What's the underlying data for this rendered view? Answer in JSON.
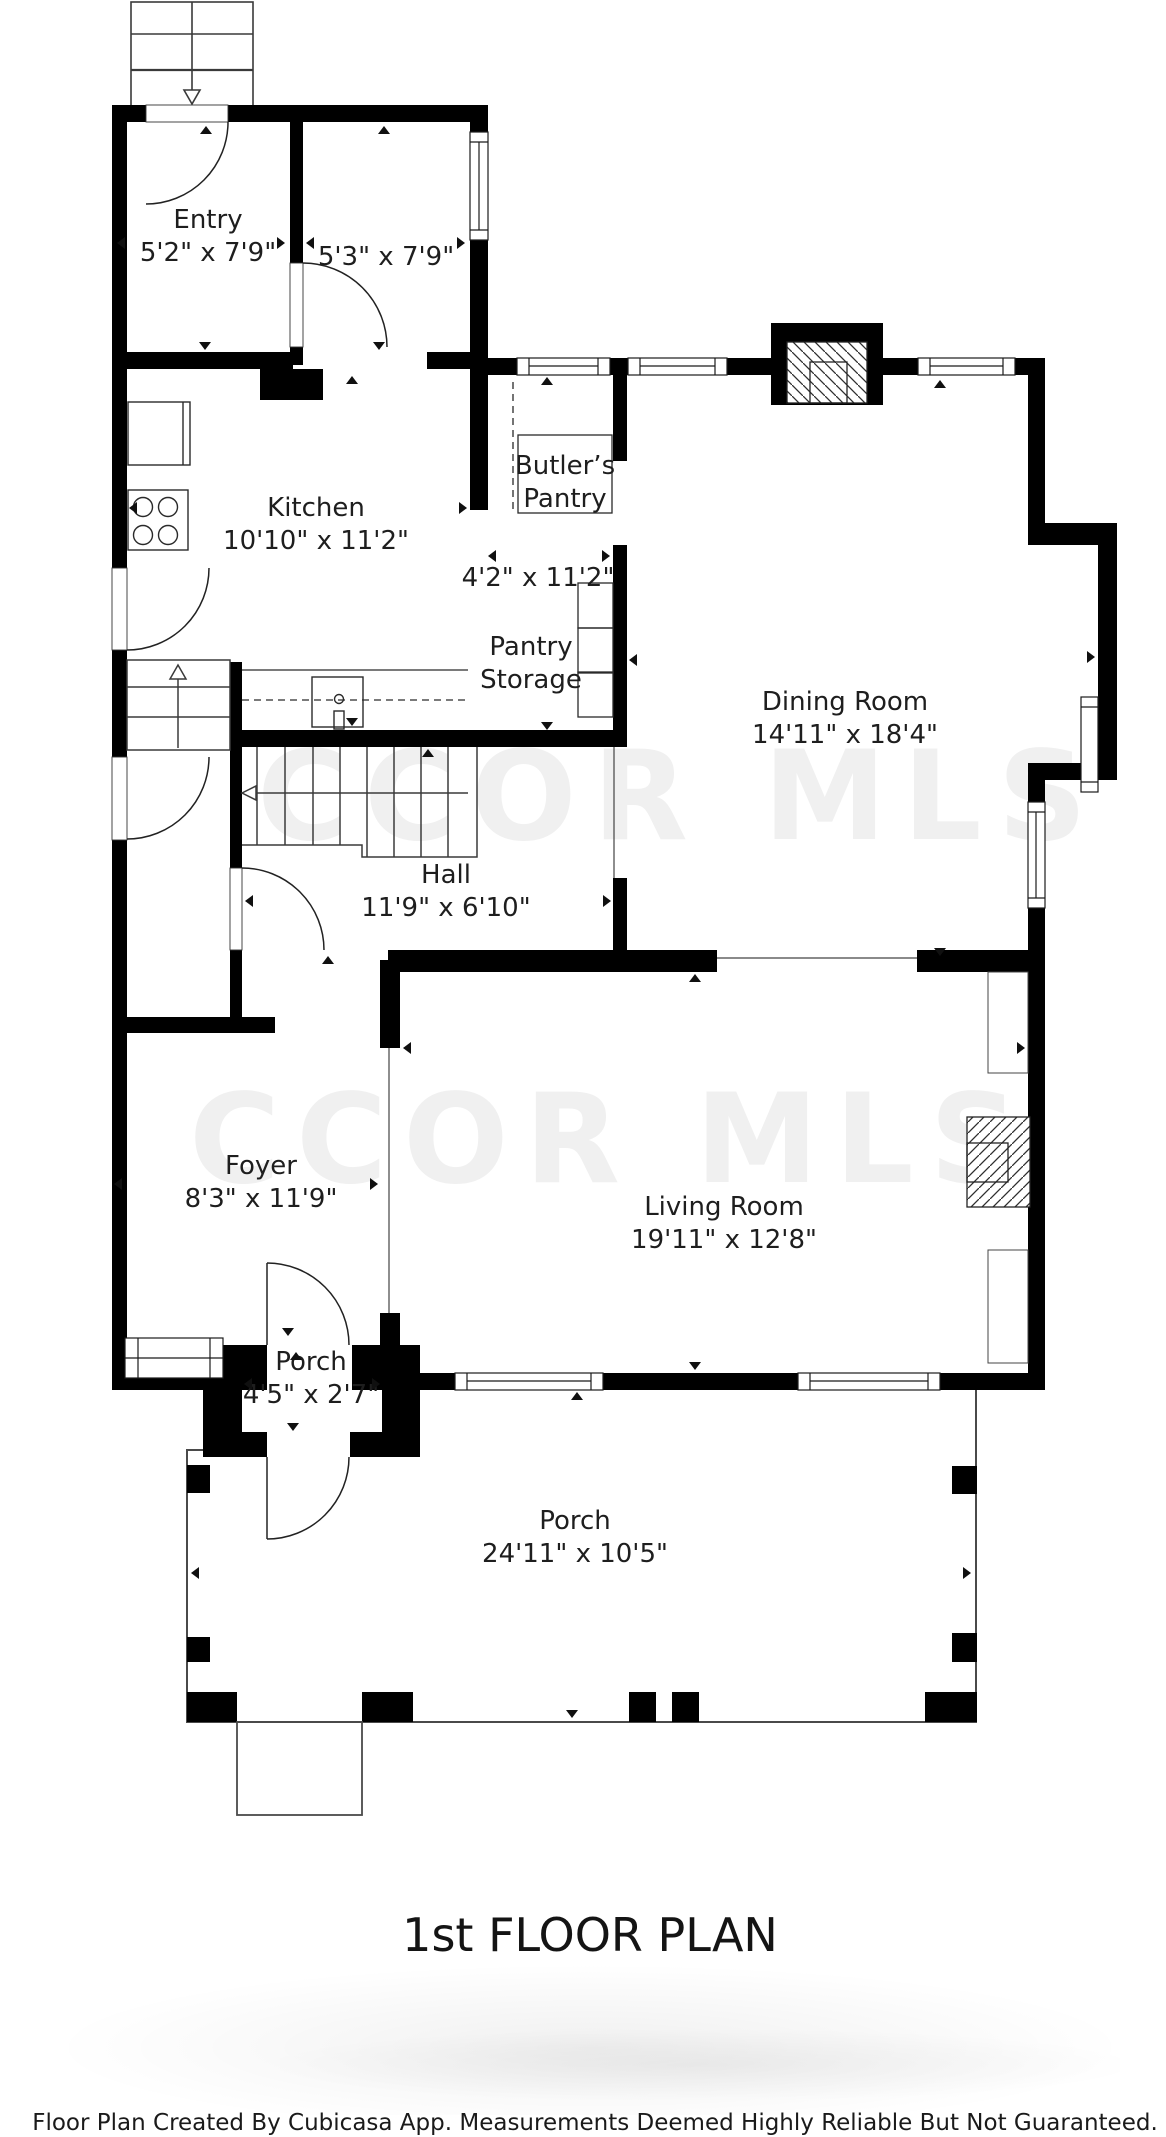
{
  "meta": {
    "title": "1st FLOOR PLAN",
    "footer": "Floor Plan Created By Cubicasa App. Measurements Deemed Highly Reliable But Not Guaranteed.",
    "watermark": "CCOR MLS"
  },
  "colors": {
    "wall": "#000000",
    "background": "#ffffff",
    "thin_line": "#333333",
    "watermark": "#f0f0f0",
    "label_text": "#1e1e1e"
  },
  "rooms": [
    {
      "id": "entry",
      "name": "Entry",
      "dims": "5'2\" x 7'9\"",
      "label_x": 208,
      "label_y": 204,
      "arrows": [
        {
          "dir": "left",
          "x": 121,
          "y": 243
        },
        {
          "dir": "right",
          "x": 281,
          "y": 243
        },
        {
          "dir": "up",
          "x": 206,
          "y": 130
        },
        {
          "dir": "down",
          "x": 205,
          "y": 346
        }
      ]
    },
    {
      "id": "mudroom",
      "name": "",
      "dims": "5'3\" x 7'9\"",
      "label_x": 386,
      "label_y": 241,
      "arrows": [
        {
          "dir": "left",
          "x": 310,
          "y": 243
        },
        {
          "dir": "right",
          "x": 461,
          "y": 243
        },
        {
          "dir": "up",
          "x": 384,
          "y": 130
        },
        {
          "dir": "down",
          "x": 379,
          "y": 346
        }
      ]
    },
    {
      "id": "kitchen",
      "name": "Kitchen",
      "dims": "10'10\" x 11'2\"",
      "label_x": 316,
      "label_y": 492,
      "arrows": [
        {
          "dir": "left",
          "x": 133,
          "y": 508
        },
        {
          "dir": "right",
          "x": 463,
          "y": 508
        },
        {
          "dir": "up",
          "x": 352,
          "y": 380
        },
        {
          "dir": "down",
          "x": 352,
          "y": 722
        }
      ]
    },
    {
      "id": "butlers_pantry",
      "name": "Butler’s\nPantry",
      "dims": "",
      "label_x": 565,
      "label_y": 450,
      "arrows": []
    },
    {
      "id": "pantry_corridor",
      "name": "",
      "dims": "4'2\" x 11'2\"",
      "label_x": 538,
      "label_y": 562,
      "arrows": [
        {
          "dir": "left",
          "x": 492,
          "y": 556
        },
        {
          "dir": "right",
          "x": 606,
          "y": 556
        },
        {
          "dir": "up",
          "x": 547,
          "y": 381
        },
        {
          "dir": "down",
          "x": 547,
          "y": 726
        }
      ]
    },
    {
      "id": "pantry_storage",
      "name": "Pantry\nStorage",
      "dims": "",
      "label_x": 531,
      "label_y": 631,
      "arrows": []
    },
    {
      "id": "dining_room",
      "name": "Dining Room",
      "dims": "14'11\" x 18'4\"",
      "label_x": 845,
      "label_y": 686,
      "arrows": [
        {
          "dir": "left",
          "x": 633,
          "y": 660
        },
        {
          "dir": "right",
          "x": 1091,
          "y": 657
        },
        {
          "dir": "up",
          "x": 940,
          "y": 384
        },
        {
          "dir": "down",
          "x": 940,
          "y": 952
        }
      ]
    },
    {
      "id": "hall",
      "name": "Hall",
      "dims": "11'9\" x 6'10\"",
      "label_x": 446,
      "label_y": 859,
      "arrows": [
        {
          "dir": "left",
          "x": 249,
          "y": 901
        },
        {
          "dir": "right",
          "x": 607,
          "y": 901
        },
        {
          "dir": "up",
          "x": 428,
          "y": 753
        }
      ]
    },
    {
      "id": "foyer",
      "name": "Foyer",
      "dims": "8'3\" x 11'9\"",
      "label_x": 261,
      "label_y": 1150,
      "arrows": [
        {
          "dir": "left",
          "x": 118,
          "y": 1184
        },
        {
          "dir": "right",
          "x": 374,
          "y": 1184
        },
        {
          "dir": "up",
          "x": 328,
          "y": 960
        },
        {
          "dir": "down",
          "x": 288,
          "y": 1332
        }
      ]
    },
    {
      "id": "living_room",
      "name": "Living Room",
      "dims": "19'11\" x 12'8\"",
      "label_x": 724,
      "label_y": 1191,
      "arrows": [
        {
          "dir": "left",
          "x": 407,
          "y": 1048
        },
        {
          "dir": "right",
          "x": 1021,
          "y": 1048
        },
        {
          "dir": "up",
          "x": 695,
          "y": 978
        },
        {
          "dir": "down",
          "x": 695,
          "y": 1366
        }
      ]
    },
    {
      "id": "porch_small",
      "name": "Porch",
      "dims": "4'5\" x 2'7\"",
      "label_x": 311,
      "label_y": 1346,
      "arrows": [
        {
          "dir": "left",
          "x": 248,
          "y": 1384
        },
        {
          "dir": "right",
          "x": 376,
          "y": 1384
        },
        {
          "dir": "up",
          "x": 296,
          "y": 1356
        },
        {
          "dir": "down",
          "x": 293,
          "y": 1427
        }
      ]
    },
    {
      "id": "porch_large",
      "name": "Porch",
      "dims": "24'11\" x 10'5\"",
      "label_x": 575,
      "label_y": 1505,
      "arrows": [
        {
          "dir": "left",
          "x": 195,
          "y": 1573
        },
        {
          "dir": "right",
          "x": 967,
          "y": 1573
        },
        {
          "dir": "up",
          "x": 577,
          "y": 1396
        },
        {
          "dir": "down",
          "x": 572,
          "y": 1714
        }
      ]
    }
  ]
}
